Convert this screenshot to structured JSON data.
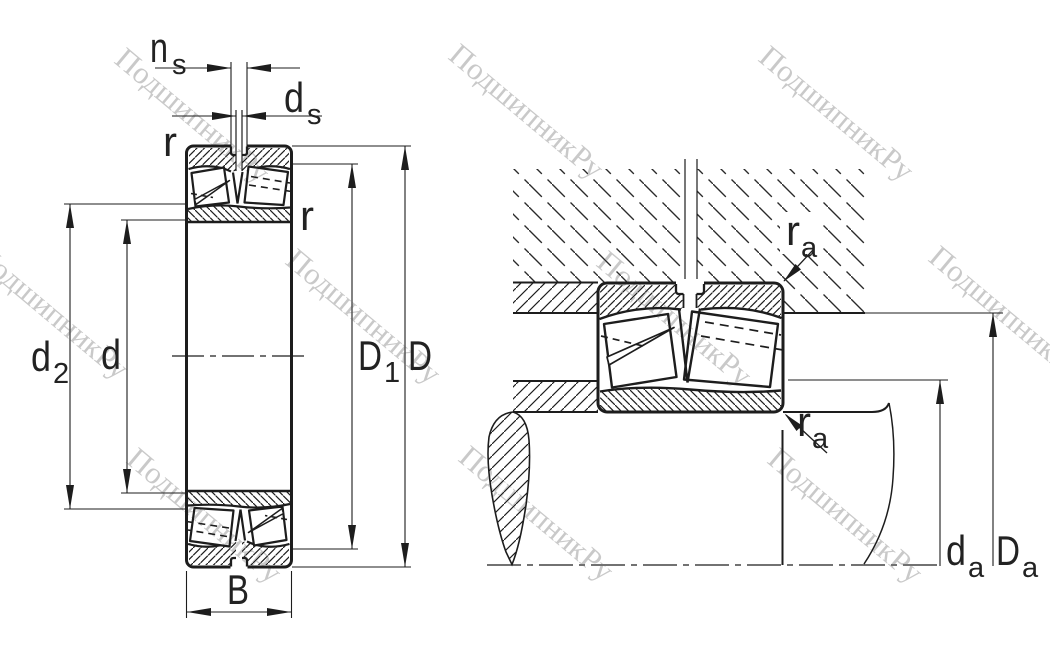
{
  "title": "spherical roller bearing dimension drawing",
  "labels": {
    "ns": {
      "main": "n",
      "sub": "s"
    },
    "ds": {
      "main": "d",
      "sub": "s"
    },
    "r_top": "r",
    "r_side": "r",
    "d2": {
      "main": "d",
      "sub": "2"
    },
    "d": "d",
    "D1": {
      "main": "D",
      "sub": "1"
    },
    "D": "D",
    "B": "B",
    "ra_top": {
      "main": "r",
      "sub": "a"
    },
    "ra_bottom": {
      "main": "r",
      "sub": "a"
    },
    "da": {
      "main": "d",
      "sub": "a"
    },
    "Da": {
      "main": "D",
      "sub": "a"
    }
  },
  "watermark": {
    "text": "ПодшипникРу",
    "color": "#c9c9c9"
  },
  "colors": {
    "line": "#1d1d1d",
    "background": "#ffffff"
  }
}
